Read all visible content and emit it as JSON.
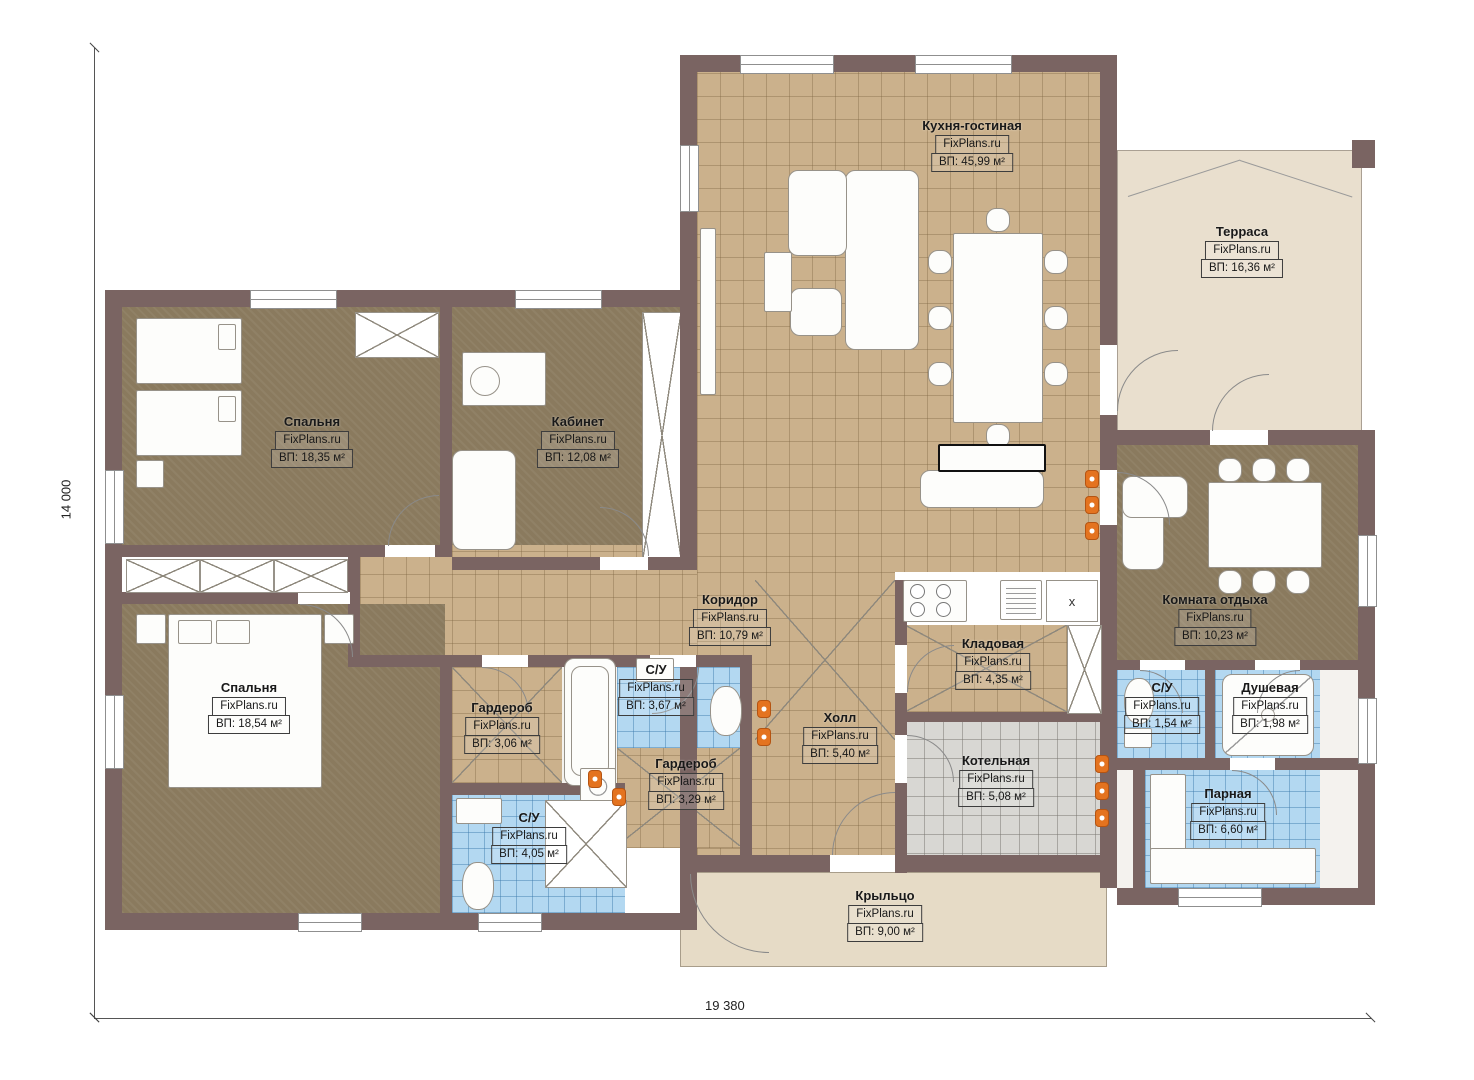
{
  "plan": {
    "title": "Floor plan of a single-storey house",
    "brand": "FixPlans.ru",
    "dimensions": {
      "height": "14 000",
      "width": "19 380"
    },
    "symbols": {
      "kitchen_x": "x"
    },
    "colors": {
      "wall": "#7a6462",
      "tile_tan": "#cbb18c",
      "floor_brown": "#8a7a5e",
      "tile_blue": "#b3d8f1",
      "tile_gray": "#d8d7d3",
      "terrace_beige": "#e9dfce",
      "porch_beige": "#e6dbc6",
      "radiator_orange": "#e4731f"
    }
  },
  "rooms": [
    {
      "name": "Кухня-гостиная",
      "area": "ВП: 45,99 м²"
    },
    {
      "name": "Терраса",
      "area": "ВП: 16,36 м²"
    },
    {
      "name": "Спальня",
      "area": "ВП: 18,35 м²"
    },
    {
      "name": "Кабинет",
      "area": "ВП: 12,08 м²"
    },
    {
      "name": "Коридор",
      "area": "ВП: 10,79 м²"
    },
    {
      "name": "Спальня",
      "area": "ВП: 18,54 м²"
    },
    {
      "name": "Гардероб",
      "area": "ВП: 3,06 м²"
    },
    {
      "name": "С/У",
      "area": "ВП: 3,67 м²"
    },
    {
      "name": "Гардероб",
      "area": "ВП: 3,29 м²"
    },
    {
      "name": "С/У",
      "area": "ВП: 4,05 м²"
    },
    {
      "name": "Холл",
      "area": "ВП: 5,40 м²"
    },
    {
      "name": "Кладовая",
      "area": "ВП: 4,35 м²"
    },
    {
      "name": "Котельная",
      "area": "ВП: 5,08 м²"
    },
    {
      "name": "Комната отдыха",
      "area": "ВП: 10,23 м²"
    },
    {
      "name": "С/У",
      "area": "ВП: 1,54 м²"
    },
    {
      "name": "Душевая",
      "area": "ВП: 1,98 м²"
    },
    {
      "name": "Парная",
      "area": "ВП: 6,60 м²"
    },
    {
      "name": "Крыльцо",
      "area": "ВП: 9,00 м²"
    }
  ]
}
